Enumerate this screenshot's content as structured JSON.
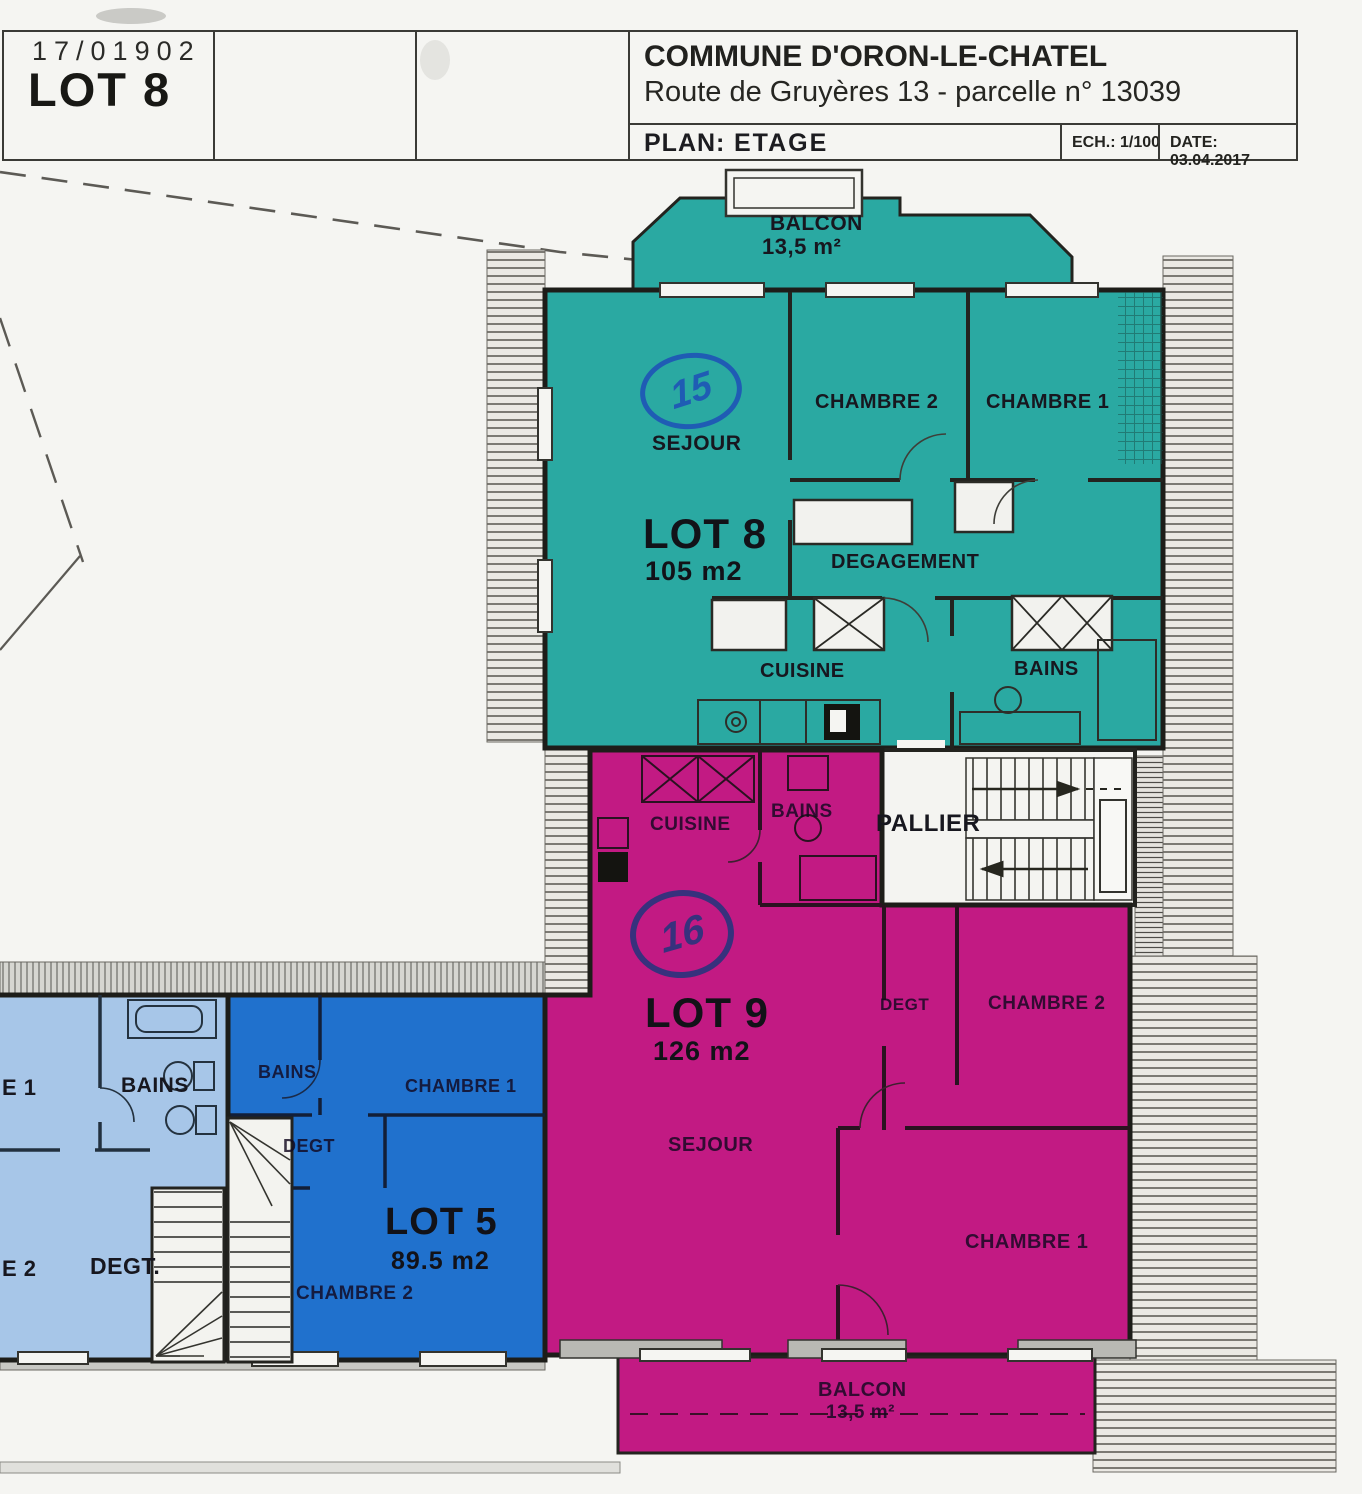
{
  "title_block": {
    "project_no": "17/01902",
    "lot": "LOT 8"
  },
  "header": {
    "commune": "COMMUNE D'ORON-LE-CHATEL",
    "address": "Route de Gruyères 13 - parcelle n° 13039",
    "plan_label": "PLAN:",
    "plan_value": "ETAGE",
    "scale": "ECH.: 1/100",
    "date": "DATE: 03.04.2017"
  },
  "lots": {
    "lot8": {
      "name": "LOT 8",
      "area": "105 m2",
      "mark": "15",
      "rooms": {
        "sejour": "SEJOUR",
        "chambre2": "CHAMBRE 2",
        "chambre1": "CHAMBRE 1",
        "degagement": "DEGAGEMENT",
        "cuisine": "CUISINE",
        "bains": "BAINS"
      },
      "balcon": {
        "label": "BALCON",
        "area": "13,5 m²"
      }
    },
    "lot9": {
      "name": "LOT 9",
      "area": "126 m2",
      "mark": "16",
      "rooms": {
        "cuisine": "CUISINE",
        "bains": "BAINS",
        "degt": "DEGT",
        "chambre2": "CHAMBRE 2",
        "sejour": "SEJOUR",
        "chambre1": "CHAMBRE 1"
      },
      "balcon": {
        "label": "BALCON",
        "area": "13,5 m²"
      }
    },
    "lot5": {
      "name": "LOT 5",
      "area": "89.5 m2",
      "rooms": {
        "bains": "BAINS",
        "chambre1": "CHAMBRE 1",
        "degt": "DEGT",
        "chambre2": "CHAMBRE 2"
      }
    },
    "lot_west": {
      "rooms": {
        "chambre1_partial": "E 1",
        "bains": "BAINS",
        "chambre2_partial": "E 2",
        "degt": "DEGT."
      }
    },
    "common": {
      "pallier": "PALLIER"
    }
  },
  "colors": {
    "lot8_teal": "#2aa9a2",
    "lot9_magenta": "#c21a83",
    "lot5_blue": "#2071cd",
    "lot_west_lightblue": "#a7c6e8",
    "mark15_ink": "#1f5cb4",
    "mark16_ink": "#37317d",
    "wall": "#23231f"
  }
}
